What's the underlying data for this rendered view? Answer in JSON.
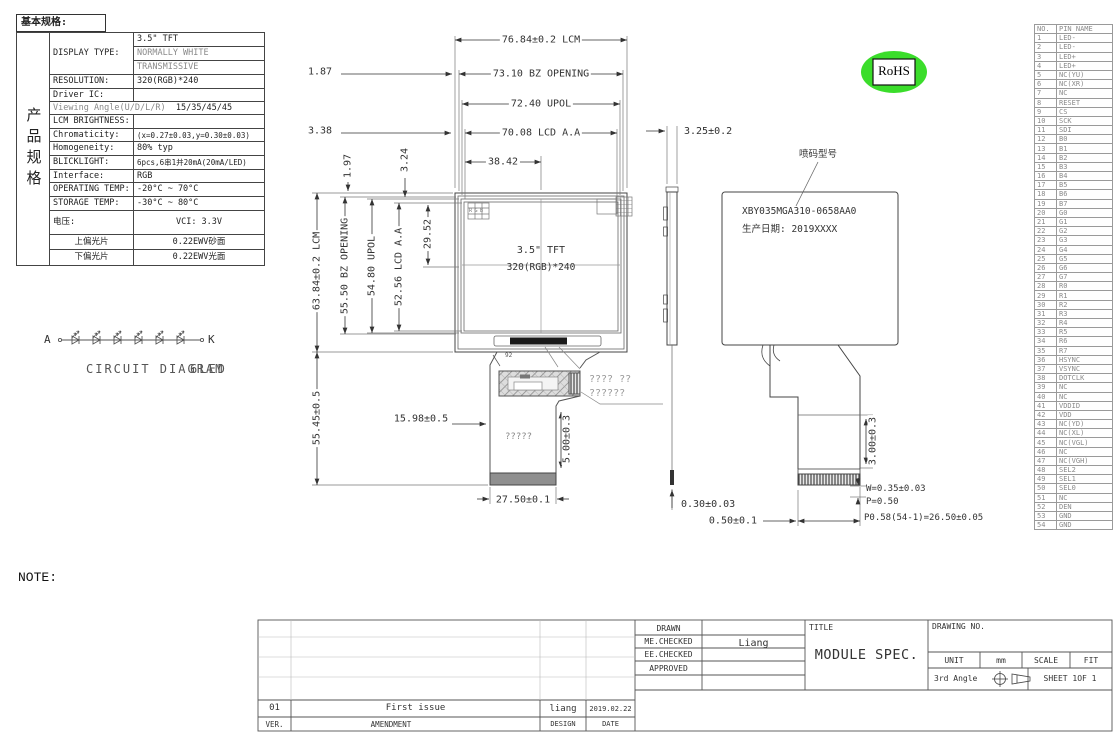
{
  "spec": {
    "header": "基本规格:",
    "side_label": "产品规格",
    "display_type_label": "DISPLAY TYPE:",
    "display_type_1": "3.5\" TFT",
    "display_type_2": "NORMALLY WHITE",
    "display_type_3": "TRANSMISSIVE",
    "resolution_label": "RESOLUTION:",
    "resolution": "320(RGB)*240",
    "driver_ic_label": "Driver IC:",
    "viewing_angle_label": "Viewing Angle(U/D/L/R)",
    "viewing_angle": "15/35/45/45",
    "brightness_label": "LCM BRIGHTNESS:",
    "chromaticity_label": "Chromaticity:",
    "chromaticity": "(x=0.27±0.03,y=0.30±0.03)",
    "homogeneity_label": "Homogeneity:",
    "homogeneity": "80% typ",
    "backlight_label": "BLICKLIGHT:",
    "backlight": "6pcs,6串1并20mA(20mA/LED)",
    "interface_label": "Interface:",
    "interface": "RGB",
    "operating_temp_label": "OPERATING TEMP:",
    "operating_temp": "-20°C ~ 70°C",
    "storage_temp_label": "STORAGE TEMP:",
    "storage_temp": "-30°C ~ 80°C",
    "voltage_label": "电压:",
    "voltage": "VCI: 3.3V",
    "top_polarizer_label": "上偏光片",
    "top_polarizer": "0.22EWV砂面",
    "bottom_polarizer_label": "下偏光片",
    "bottom_polarizer": "0.22EWV光面"
  },
  "circuit": {
    "anode": "A",
    "cathode": "K",
    "label": "CIRCUIT DIAGRAM",
    "sub": "6LED"
  },
  "front_view": {
    "size": "3.5\" TFT",
    "resolution": "320(RGB)*240",
    "pixel_icon": "RGB",
    "slot_mark": "92"
  },
  "fpc": {
    "center_text": "?????",
    "note_line1": "????    ??",
    "note_line2": "??????"
  },
  "back_view": {
    "marking_label": "喷码型号",
    "model": "XBY035MGA310-0658AA0",
    "date": "生产日期: 2019XXXX"
  },
  "badge": {
    "rohs": "RoHS"
  },
  "dims": {
    "lcm_w": "76.84±0.2  LCM",
    "off_187": "1.87",
    "bz_w": "73.10  BZ OPENING",
    "upol_w": "72.40  UPOL",
    "off_338": "3.38",
    "aa_w": "70.08  LCD A.A",
    "half_w": "38.42",
    "off_197": "1.97",
    "off_324": "3.24",
    "lcm_h": "63.84±0.2  LCM",
    "bz_h": "55.50 BZ OPENING",
    "upol_h": "54.80 UPOL",
    "aa_h": "52.56 LCD A.A",
    "half_h": "29.52",
    "fpc_len": "55.45±0.5",
    "fpc_off": "15.98±0.5",
    "gold_len": "5.00±0.3",
    "fpc_w": "27.50±0.1",
    "thickness": "3.25±0.2",
    "tape": "0.30±0.03",
    "gap": "0.50±0.1",
    "conn_h": "3.00±0.3",
    "finger_w": "W=0.35±0.03",
    "pitch": "P=0.50",
    "pitch_total": "P0.58(54-1)=26.50±0.05"
  },
  "notes": {
    "title": "NOTE:",
    "items": [
      "1. GENERAL TOLERANCE: ±0.2.",
      "2. (...) IS REFERENCE DIMENSION.",
      "3. * CRITICAL DIMENSION",
      "4. COMPLIABLY RoHS."
    ]
  },
  "pins": {
    "col_no": "NO.",
    "col_name": "PIN NAME",
    "rows": [
      {
        "no": "1",
        "name": "LED-"
      },
      {
        "no": "2",
        "name": "LED-"
      },
      {
        "no": "3",
        "name": "LED+"
      },
      {
        "no": "4",
        "name": "LED+"
      },
      {
        "no": "5",
        "name": "NC(YU)"
      },
      {
        "no": "6",
        "name": "NC(XR)"
      },
      {
        "no": "7",
        "name": "NC"
      },
      {
        "no": "8",
        "name": "RESET"
      },
      {
        "no": "9",
        "name": "CS"
      },
      {
        "no": "10",
        "name": "SCK"
      },
      {
        "no": "11",
        "name": "SDI"
      },
      {
        "no": "12",
        "name": "B0"
      },
      {
        "no": "13",
        "name": "B1"
      },
      {
        "no": "14",
        "name": "B2"
      },
      {
        "no": "15",
        "name": "B3"
      },
      {
        "no": "16",
        "name": "B4"
      },
      {
        "no": "17",
        "name": "B5"
      },
      {
        "no": "18",
        "name": "B6"
      },
      {
        "no": "19",
        "name": "B7"
      },
      {
        "no": "20",
        "name": "G0"
      },
      {
        "no": "21",
        "name": "G1"
      },
      {
        "no": "22",
        "name": "G2"
      },
      {
        "no": "23",
        "name": "G3"
      },
      {
        "no": "24",
        "name": "G4"
      },
      {
        "no": "25",
        "name": "G5"
      },
      {
        "no": "26",
        "name": "G6"
      },
      {
        "no": "27",
        "name": "G7"
      },
      {
        "no": "28",
        "name": "R0"
      },
      {
        "no": "29",
        "name": "R1"
      },
      {
        "no": "30",
        "name": "R2"
      },
      {
        "no": "31",
        "name": "R3"
      },
      {
        "no": "32",
        "name": "R4"
      },
      {
        "no": "33",
        "name": "R5"
      },
      {
        "no": "34",
        "name": "R6"
      },
      {
        "no": "35",
        "name": "R7"
      },
      {
        "no": "36",
        "name": "HSYNC"
      },
      {
        "no": "37",
        "name": "VSYNC"
      },
      {
        "no": "38",
        "name": "DOTCLK"
      },
      {
        "no": "39",
        "name": "NC"
      },
      {
        "no": "40",
        "name": "NC"
      },
      {
        "no": "41",
        "name": "VDDID"
      },
      {
        "no": "42",
        "name": "VDD"
      },
      {
        "no": "43",
        "name": "NC(YD)"
      },
      {
        "no": "44",
        "name": "NC(XL)"
      },
      {
        "no": "45",
        "name": "NC(VGL)"
      },
      {
        "no": "46",
        "name": "NC"
      },
      {
        "no": "47",
        "name": "NC(VGH)"
      },
      {
        "no": "48",
        "name": "SEL2"
      },
      {
        "no": "49",
        "name": "SEL1"
      },
      {
        "no": "50",
        "name": "SEL0"
      },
      {
        "no": "51",
        "name": "NC"
      },
      {
        "no": "52",
        "name": "DEN"
      },
      {
        "no": "53",
        "name": "GND"
      },
      {
        "no": "54",
        "name": "GND"
      }
    ]
  },
  "title_block": {
    "drawn": "DRAWN",
    "me_checked": "ME.CHECKED",
    "ee_checked": "EE.CHECKED",
    "approved": "APPROVED",
    "checker": "Liang",
    "title_label": "TITLE",
    "title": "MODULE SPEC.",
    "drawing_no_label": "DRAWING NO.",
    "unit_label": "UNIT",
    "unit": "mm",
    "scale_label": "SCALE",
    "scale": "FIT",
    "projection": "3rd Angle",
    "sheet": "SHEET  1OF  1"
  },
  "revision": {
    "ver": "01",
    "amendment": "First issue",
    "design": "liang",
    "date": "2019.02.22",
    "ver_label": "VER.",
    "amendment_label": "AMENDMENT",
    "design_label": "DESIGN",
    "date_label": "DATE"
  }
}
